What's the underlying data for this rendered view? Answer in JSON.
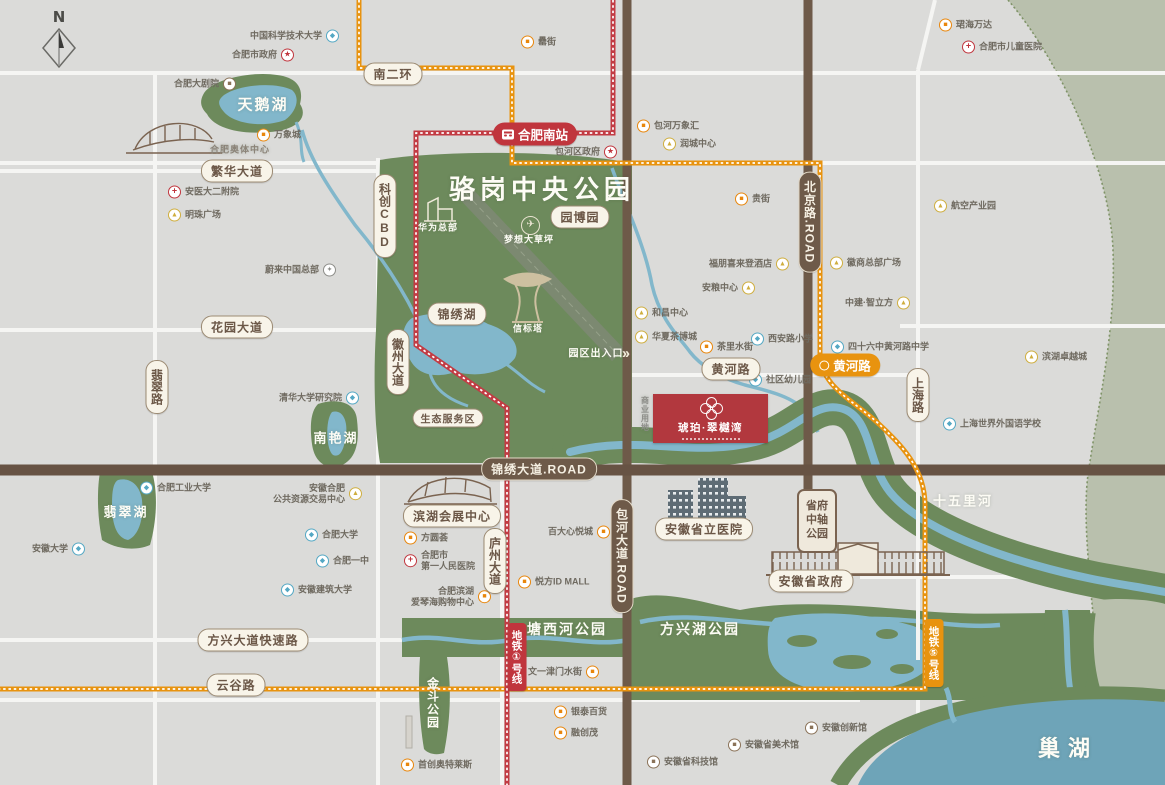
{
  "compass": {
    "label": "N"
  },
  "project": {
    "name": "琥珀·翠樾湾"
  },
  "colors": {
    "park_green": "#6d8a5c",
    "sage": "#b9c0ad",
    "water": "#82b7cb",
    "lake_big": "#6ea4b8",
    "road_brown": "#6e5a49",
    "metro_red": "#c23b43",
    "metro_orange": "#e8930f",
    "project_red": "#b2383e"
  },
  "icon_glyphs": {
    "mall": "■",
    "biz": "▲",
    "school": "◆",
    "hosp": "+",
    "gov": "★",
    "culture": "■",
    "theater": "■",
    "nio": "✦"
  },
  "road_pills": [
    {
      "label": "南二环",
      "x": 393,
      "y": 74
    },
    {
      "label": "繁华大道",
      "x": 237,
      "y": 171
    },
    {
      "label": "花园大道",
      "x": 237,
      "y": 327
    },
    {
      "label": "翡翠路",
      "x": 157,
      "y": 387,
      "v": true
    },
    {
      "label": "徽州大道",
      "x": 398,
      "y": 362,
      "v": true
    },
    {
      "label": "科创CBD",
      "x": 385,
      "y": 216,
      "v": true
    },
    {
      "label": "锦绣湖",
      "x": 457,
      "y": 314
    },
    {
      "label": "园博园",
      "x": 580,
      "y": 217
    },
    {
      "label": "生态服务区",
      "x": 448,
      "y": 418,
      "small": true
    },
    {
      "label": "黄河路",
      "x": 731,
      "y": 369
    },
    {
      "label": "上海路",
      "x": 918,
      "y": 395,
      "v": true
    },
    {
      "label": "庐州大道",
      "x": 495,
      "y": 561,
      "v": true
    },
    {
      "label": "方兴大道快速路",
      "x": 253,
      "y": 640
    },
    {
      "label": "云谷路",
      "x": 236,
      "y": 685
    },
    {
      "label": "滨湖会展中心",
      "x": 452,
      "y": 516
    },
    {
      "label": "安徽省立医院",
      "x": 704,
      "y": 529
    },
    {
      "label": "安徽省政府",
      "x": 811,
      "y": 581
    }
  ],
  "dark_pills": [
    {
      "label": "锦绣大道.ROAD",
      "x": 539,
      "y": 469
    },
    {
      "label": "北京路.ROAD",
      "x": 810,
      "y": 222,
      "v": true
    },
    {
      "label": "包河大道.ROAD",
      "x": 622,
      "y": 556,
      "v": true
    }
  ],
  "metro_badges": [
    {
      "label": "合肥南站",
      "x": 535,
      "y": 134,
      "color": "red",
      "icon": "train"
    },
    {
      "label": "黄河路",
      "x": 845,
      "y": 365,
      "color": "orange",
      "icon": "metro"
    },
    {
      "label": "地铁①号线",
      "x": 517,
      "y": 657,
      "color": "red",
      "v": true
    },
    {
      "label": "地铁⑤号线",
      "x": 934,
      "y": 653,
      "color": "orange",
      "v": true
    }
  ],
  "gov_park_badge": {
    "label": "省府中轴公园"
  },
  "area_labels": [
    {
      "label": "骆岗中央公园",
      "x": 542,
      "y": 188,
      "size": 26,
      "ls": 5
    },
    {
      "label": "天鹅湖",
      "x": 263,
      "y": 104,
      "size": 15
    },
    {
      "label": "南艳湖",
      "x": 336,
      "y": 437,
      "size": 13
    },
    {
      "label": "翡翠湖",
      "x": 126,
      "y": 511,
      "size": 13
    },
    {
      "label": "十五里河",
      "x": 963,
      "y": 500,
      "size": 13
    },
    {
      "label": "塘西河公园",
      "x": 567,
      "y": 629,
      "size": 14
    },
    {
      "label": "方兴湖公园",
      "x": 700,
      "y": 629,
      "size": 14
    },
    {
      "label": "金斗公园",
      "x": 433,
      "y": 703,
      "size": 12,
      "v": true
    },
    {
      "label": "巢湖",
      "x": 1068,
      "y": 747,
      "size": 22,
      "ls": 8
    },
    {
      "label": "梦想大草坪",
      "x": 529,
      "y": 239,
      "size": 9,
      "ls": 1
    },
    {
      "label": "信标塔",
      "x": 528,
      "y": 328,
      "size": 9,
      "ls": 1
    },
    {
      "label": "华为总部",
      "x": 438,
      "y": 227,
      "size": 9,
      "ls": 1
    },
    {
      "label": "园区出入口",
      "x": 596,
      "y": 352,
      "size": 10,
      "ls": 1
    },
    {
      "label": "商业用地",
      "x": 645,
      "y": 414,
      "size": 8,
      "v": true,
      "color": "#8d8d89"
    },
    {
      "label": "合肥奥体中心",
      "x": 240,
      "y": 149,
      "size": 9,
      "color": "#8b8378",
      "ls": 1
    }
  ],
  "pois": [
    {
      "label": "中国科学技术大学",
      "icon": "school",
      "x": 332,
      "y": 36,
      "side": "left"
    },
    {
      "label": "合肥市政府",
      "icon": "gov",
      "x": 287,
      "y": 55,
      "side": "left"
    },
    {
      "label": "合肥大剧院",
      "icon": "theater",
      "x": 229,
      "y": 84,
      "side": "left"
    },
    {
      "label": "万象城",
      "icon": "mall",
      "x": 264,
      "y": 135,
      "side": "right"
    },
    {
      "label": "罍街",
      "icon": "mall",
      "x": 528,
      "y": 42,
      "side": "right"
    },
    {
      "label": "包河区政府",
      "icon": "gov",
      "x": 610,
      "y": 152,
      "side": "left"
    },
    {
      "label": "包河万象汇",
      "icon": "mall",
      "x": 644,
      "y": 126,
      "side": "right"
    },
    {
      "label": "润城中心",
      "icon": "biz",
      "x": 670,
      "y": 144,
      "side": "right"
    },
    {
      "label": "珺海万达",
      "icon": "mall",
      "x": 946,
      "y": 25,
      "side": "right"
    },
    {
      "label": "合肥市儿童医院",
      "icon": "hosp",
      "x": 969,
      "y": 47,
      "side": "right"
    },
    {
      "label": "安医大二附院",
      "icon": "hosp",
      "x": 175,
      "y": 192,
      "side": "right"
    },
    {
      "label": "明珠广场",
      "icon": "biz",
      "x": 175,
      "y": 215,
      "side": "right"
    },
    {
      "label": "蔚来中国总部",
      "icon": "nio",
      "x": 329,
      "y": 270,
      "side": "left"
    },
    {
      "label": "清华大学研究院",
      "icon": "school",
      "x": 352,
      "y": 398,
      "side": "left"
    },
    {
      "label": "合肥工业大学",
      "icon": "school",
      "x": 147,
      "y": 488,
      "side": "right"
    },
    {
      "label": "安徽大学",
      "icon": "school",
      "x": 78,
      "y": 549,
      "side": "left"
    },
    {
      "label": "贵街",
      "icon": "mall",
      "x": 742,
      "y": 199,
      "side": "right"
    },
    {
      "label": "福朋喜来登酒店",
      "icon": "biz",
      "x": 782,
      "y": 264,
      "side": "left"
    },
    {
      "label": "徽商总部广场",
      "icon": "biz",
      "x": 837,
      "y": 263,
      "side": "right"
    },
    {
      "label": "安粮中心",
      "icon": "biz",
      "x": 748,
      "y": 288,
      "side": "left"
    },
    {
      "label": "中建·智立方",
      "icon": "biz",
      "x": 903,
      "y": 303,
      "side": "left"
    },
    {
      "label": "西安路小学",
      "icon": "school",
      "x": 758,
      "y": 339,
      "side": "right"
    },
    {
      "label": "四十六中黄河路中学",
      "icon": "school",
      "x": 838,
      "y": 347,
      "side": "right"
    },
    {
      "label": "茶里水街",
      "icon": "mall",
      "x": 707,
      "y": 347,
      "side": "right"
    },
    {
      "label": "社区幼儿园",
      "icon": "school",
      "x": 756,
      "y": 380,
      "side": "right"
    },
    {
      "label": "和昌中心",
      "icon": "biz",
      "x": 642,
      "y": 313,
      "side": "right"
    },
    {
      "label": "华夏茶博城",
      "icon": "biz",
      "x": 642,
      "y": 337,
      "side": "right"
    },
    {
      "label": "航空产业园",
      "icon": "biz",
      "x": 941,
      "y": 206,
      "side": "right"
    },
    {
      "label": "滨湖卓越城",
      "icon": "biz",
      "x": 1032,
      "y": 357,
      "side": "right"
    },
    {
      "label": "上海世界外国语学校",
      "icon": "school",
      "x": 950,
      "y": 424,
      "side": "right"
    },
    {
      "label": "安徽合肥",
      "label2": "公共资源交易中心",
      "icon": "biz",
      "x": 355,
      "y": 494,
      "side": "left"
    },
    {
      "label": "合肥大学",
      "icon": "school",
      "x": 312,
      "y": 535,
      "side": "right"
    },
    {
      "label": "合肥一中",
      "icon": "school",
      "x": 323,
      "y": 561,
      "side": "right"
    },
    {
      "label": "安徽建筑大学",
      "icon": "school",
      "x": 288,
      "y": 590,
      "side": "right"
    },
    {
      "label": "方圆荟",
      "icon": "mall",
      "x": 411,
      "y": 538,
      "side": "right"
    },
    {
      "label": "合肥市",
      "label2": "第一人民医院",
      "icon": "hosp",
      "x": 411,
      "y": 561,
      "side": "right"
    },
    {
      "label": "合肥滨湖",
      "label2": "爱琴海购物中心",
      "icon": "mall",
      "x": 484,
      "y": 597,
      "side": "left"
    },
    {
      "label": "百大心悦城",
      "icon": "mall",
      "x": 603,
      "y": 532,
      "side": "left"
    },
    {
      "label": "悦方ID MALL",
      "icon": "mall",
      "x": 525,
      "y": 582,
      "side": "right"
    },
    {
      "label": "文一津门水街",
      "icon": "mall",
      "x": 592,
      "y": 672,
      "side": "left"
    },
    {
      "label": "银泰百货",
      "icon": "mall",
      "x": 561,
      "y": 712,
      "side": "right"
    },
    {
      "label": "融创茂",
      "icon": "mall",
      "x": 561,
      "y": 733,
      "side": "right"
    },
    {
      "label": "安徽省科技馆",
      "icon": "culture",
      "x": 654,
      "y": 762,
      "side": "right"
    },
    {
      "label": "安徽省美术馆",
      "icon": "culture",
      "x": 735,
      "y": 745,
      "side": "right"
    },
    {
      "label": "安徽创新馆",
      "icon": "culture",
      "x": 812,
      "y": 728,
      "side": "right"
    },
    {
      "label": "首创奥特莱斯",
      "icon": "mall",
      "x": 408,
      "y": 765,
      "side": "right"
    }
  ]
}
